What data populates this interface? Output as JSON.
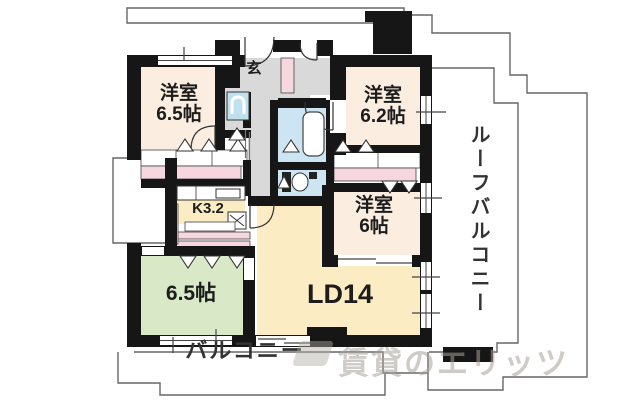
{
  "floorplan": {
    "rooms": {
      "western1": {
        "name": "洋室",
        "size": "6.5帖"
      },
      "western2": {
        "name": "洋室",
        "size": "6.2帖"
      },
      "western3": {
        "name": "洋室",
        "size": "6帖"
      },
      "kitchen": {
        "label": "K3.2"
      },
      "japanese": {
        "label": "6.5帖"
      },
      "living": {
        "label": "LD14"
      },
      "entrance": {
        "label": "玄"
      }
    },
    "roof_balcony_label": "ルーフバルコニー",
    "balcony_label": "バルコニー",
    "watermark": "賃貸のエリッツ",
    "colors": {
      "wall": "#161616",
      "room_cream": "#fbeee1",
      "room_yellow": "#fbecc3",
      "room_green": "#d9e8c7",
      "water_blue": "#cde5f2",
      "closet_pink": "#f6d7df",
      "hall_gray": "#d9d9d9",
      "outline_gray": "#666666"
    }
  }
}
